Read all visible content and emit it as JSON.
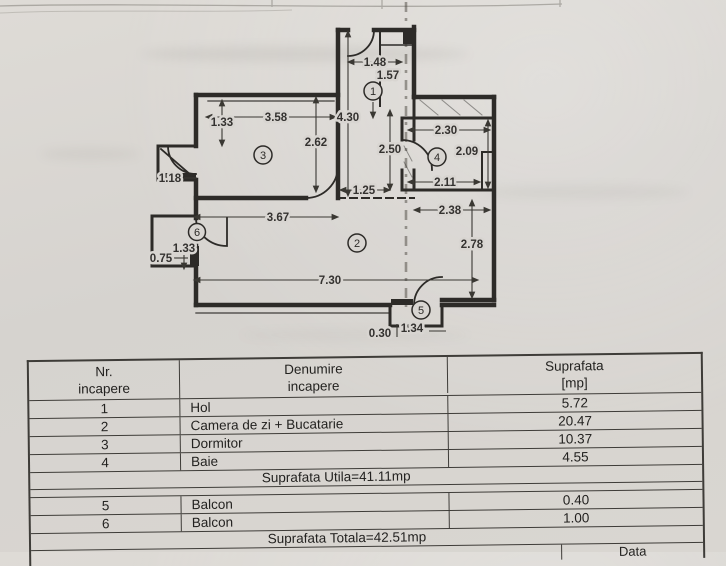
{
  "plan": {
    "room_labels": {
      "r1": "1",
      "r2": "2",
      "r3": "3",
      "r4": "4",
      "r5": "5",
      "r6": "6"
    },
    "dims": {
      "d148": "1.48",
      "d157": "1.57",
      "d430": "4.30",
      "d250": "2.50",
      "d133a": "1.33",
      "d358": "3.58",
      "d262": "2.62",
      "d118": "1.18",
      "d230": "2.30",
      "d209": "2.09",
      "d211": "2.11",
      "d125": "1.25",
      "d367": "3.67",
      "d238": "2.38",
      "d278": "2.78",
      "d730": "7.30",
      "d133b": "1.33",
      "d075": "0.75",
      "d134": "1.34",
      "d030": "0.30"
    }
  },
  "table": {
    "headers": {
      "col1_line1": "Nr.",
      "col1_line2": "incapere",
      "col2_line1": "Denumire",
      "col2_line2": "incapere",
      "col3_line1": "Suprafata",
      "col3_line2": "[mp]"
    },
    "rows": [
      {
        "nr": "1",
        "name": "Hol",
        "area": "5.72"
      },
      {
        "nr": "2",
        "name": "Camera de zi + Bucatarie",
        "area": "20.47"
      },
      {
        "nr": "3",
        "name": "Dormitor",
        "area": "10.37"
      },
      {
        "nr": "4",
        "name": "Baie",
        "area": "4.55"
      }
    ],
    "subtotal": "Suprafata Utila=41.11mp",
    "rows2": [
      {
        "nr": "5",
        "name": "Balcon",
        "area": "0.40"
      },
      {
        "nr": "6",
        "name": "Balcon",
        "area": "1.00"
      }
    ],
    "total": "Suprafata Totala=42.51mp",
    "footer_label": "Data"
  }
}
